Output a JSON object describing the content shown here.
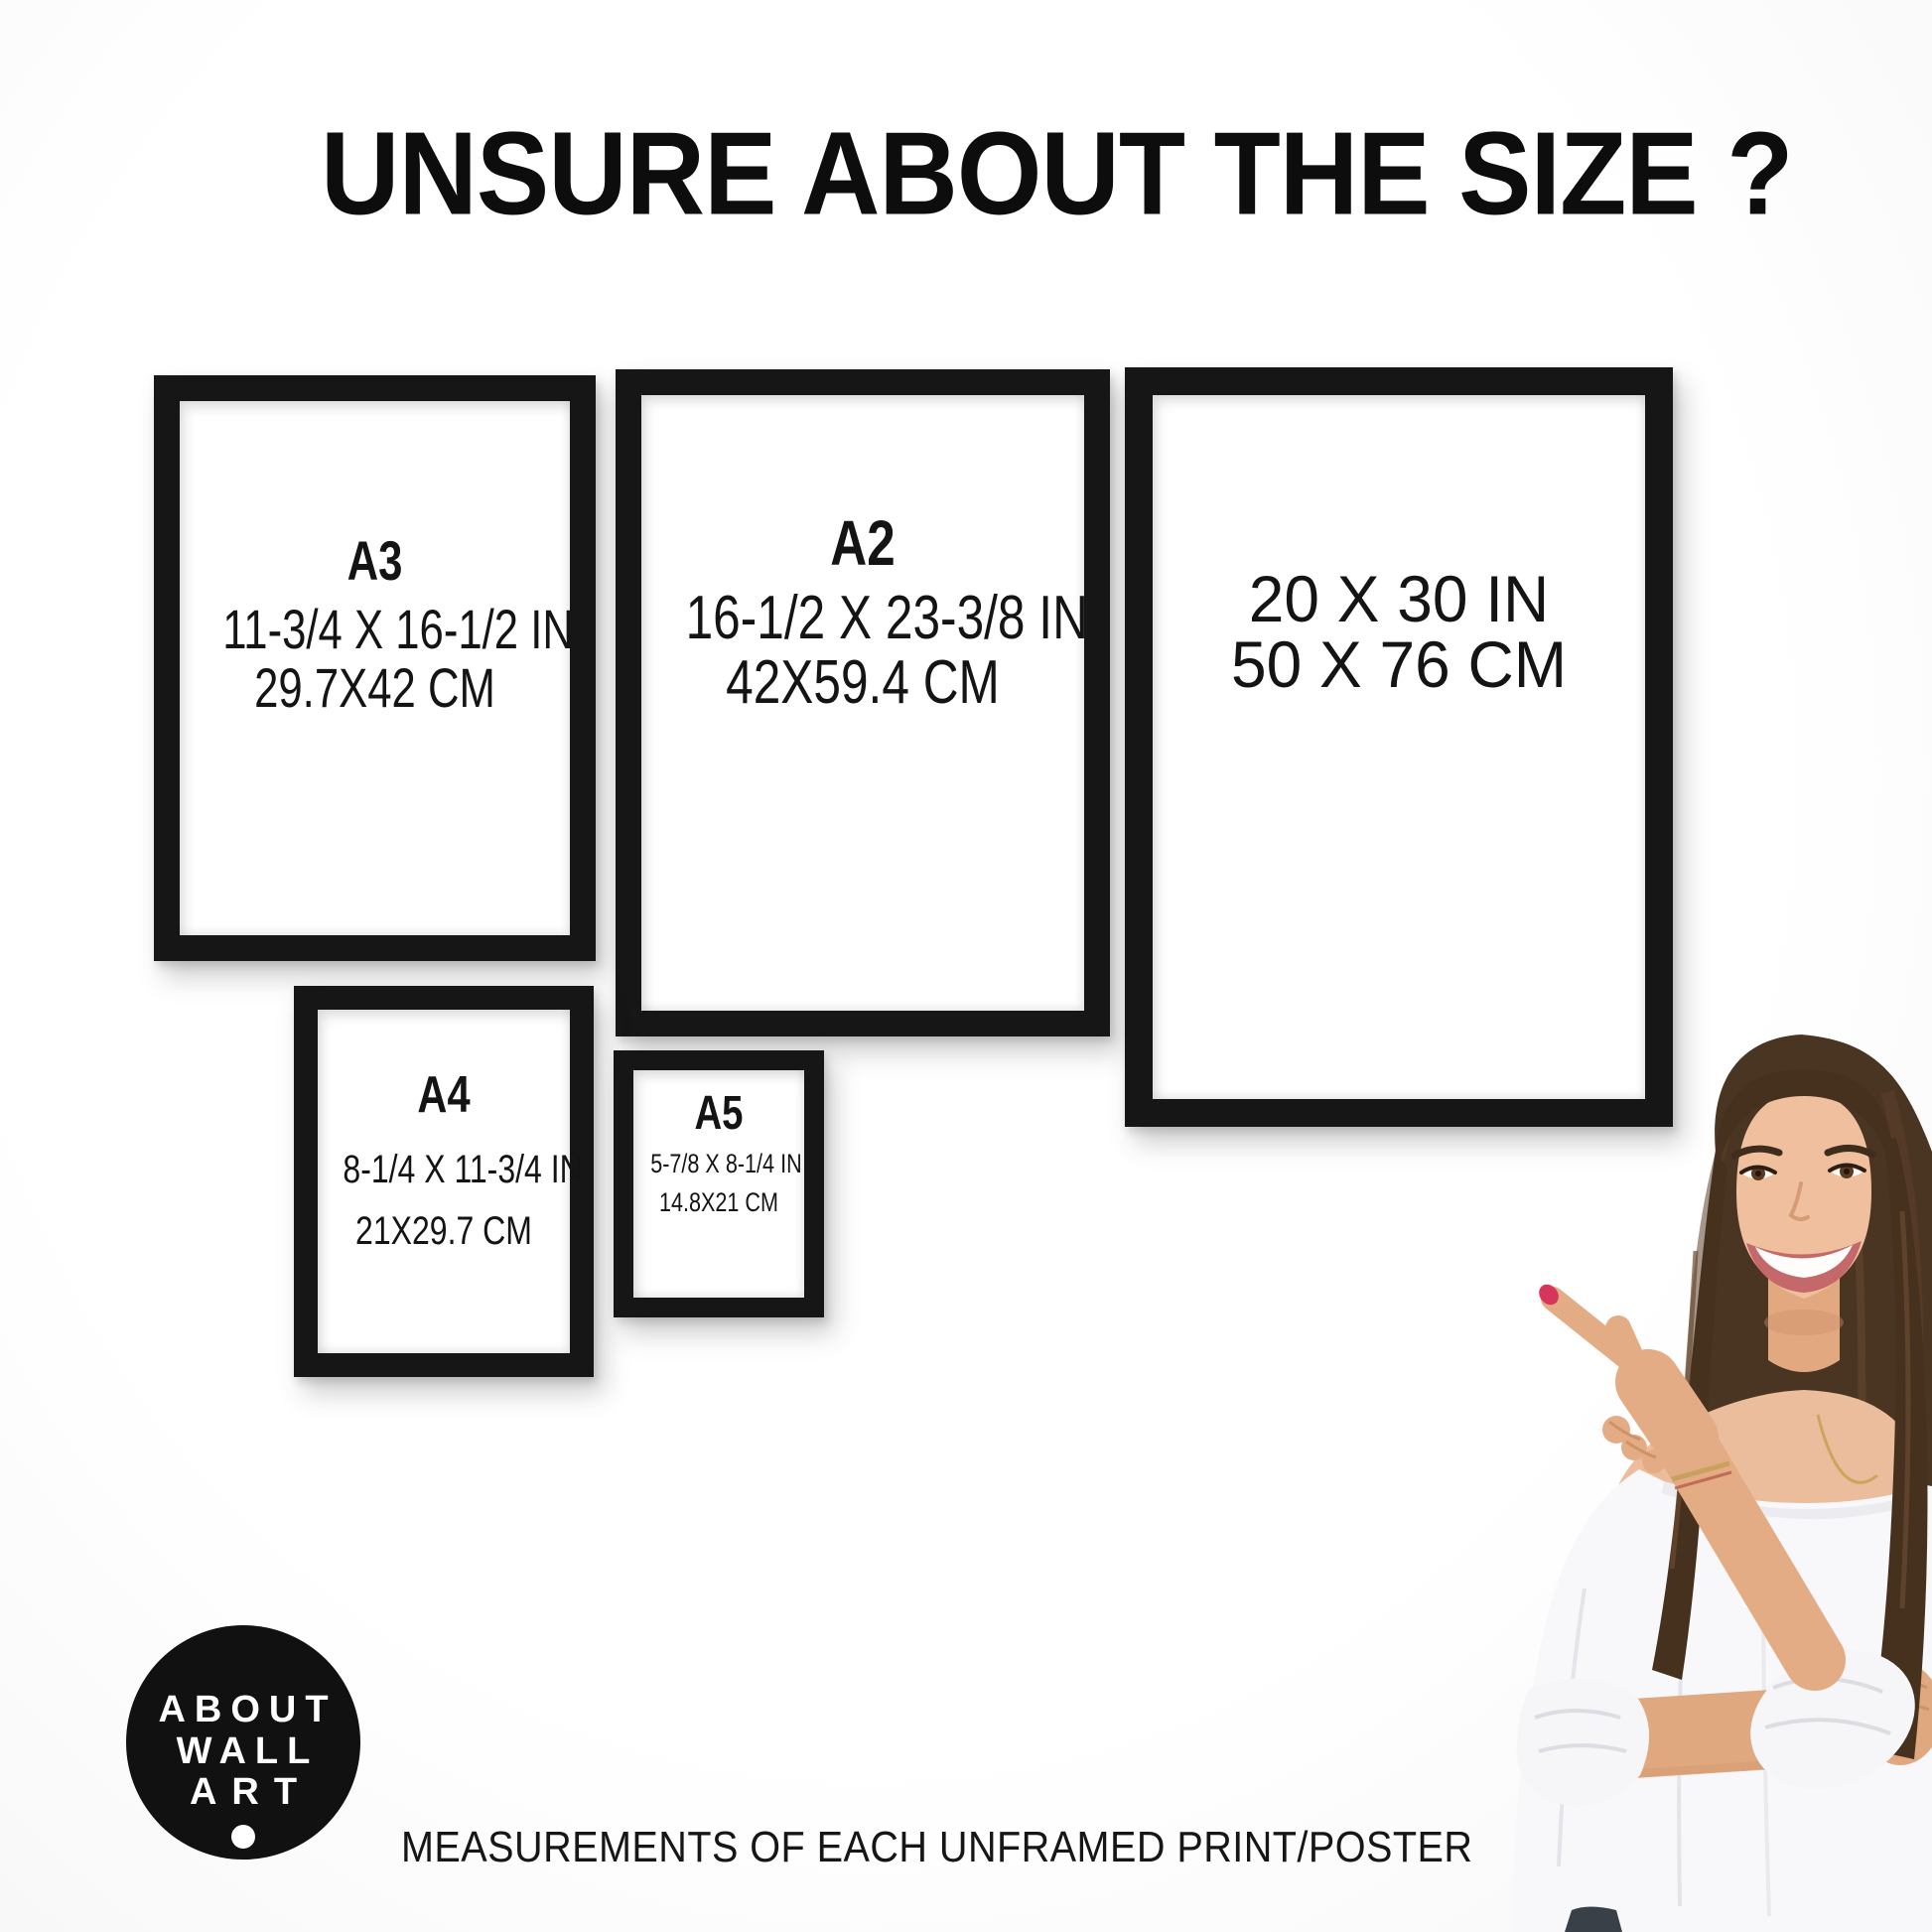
{
  "title": "UNSURE ABOUT THE SIZE ?",
  "caption": "MEASUREMENTS OF EACH UNFRAMED PRINT/POSTER",
  "frames": [
    {
      "name": "A3",
      "inches": "11-3/4 X 16-1/2 IN",
      "cm": "29.7X42 CM"
    },
    {
      "name": "A2",
      "inches": "16-1/2 X 23-3/8 IN",
      "cm": "42X59.4 CM"
    },
    {
      "name": "",
      "inches": "20 X 30 IN",
      "cm": "50 X 76 CM"
    },
    {
      "name": "A4",
      "inches": "8-1/4 X 11-3/4 IN",
      "cm": "21X29.7 CM"
    },
    {
      "name": "A5",
      "inches": "5-7/8 X 8-1/4 IN",
      "cm": "14.8X21 CM"
    }
  ],
  "logo": {
    "line1": "ABOUT",
    "line2": "WALL",
    "line3": "ART"
  },
  "colors": {
    "background": "#fcfcfc",
    "frame_black": "#161616",
    "text": "#141414",
    "logo_bg": "#111111",
    "logo_text": "#ffffff",
    "nail_red": "#d6355c",
    "hair_brown": "#4a3422",
    "skin": "#ecbd9d",
    "blouse_white": "#f8f8fa"
  }
}
